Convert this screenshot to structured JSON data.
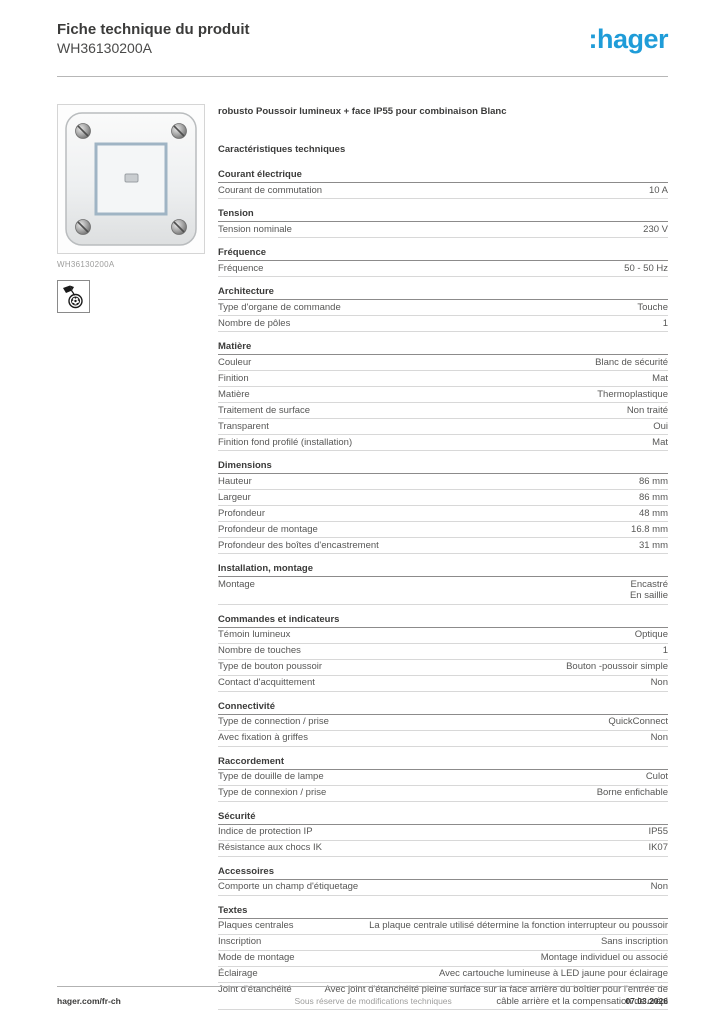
{
  "header": {
    "title": "Fiche technique du produit",
    "product_code": "WH36130200A",
    "brand": ":hager",
    "brand_color": "#1f9cd8"
  },
  "product": {
    "image_caption": "WH36130200A",
    "feature_icon": "paintable-surface-icon"
  },
  "main": {
    "product_title": "robusto Poussoir lumineux + face IP55 pour combinaison Blanc",
    "characteristics_heading": "Caractéristiques techniques",
    "sections": [
      {
        "title": "Courant électrique",
        "rows": [
          {
            "label": "Courant de commutation",
            "value": "10 A"
          }
        ]
      },
      {
        "title": "Tension",
        "rows": [
          {
            "label": "Tension nominale",
            "value": "230 V"
          }
        ]
      },
      {
        "title": "Fréquence",
        "rows": [
          {
            "label": "Fréquence",
            "value": "50 - 50 Hz"
          }
        ]
      },
      {
        "title": "Architecture",
        "rows": [
          {
            "label": "Type d'organe de commande",
            "value": "Touche"
          },
          {
            "label": "Nombre de pôles",
            "value": "1"
          }
        ]
      },
      {
        "title": "Matière",
        "rows": [
          {
            "label": "Couleur",
            "value": "Blanc de sécurité"
          },
          {
            "label": "Finition",
            "value": "Mat"
          },
          {
            "label": "Matière",
            "value": "Thermoplastique"
          },
          {
            "label": "Traitement de surface",
            "value": "Non traité"
          },
          {
            "label": "Transparent",
            "value": "Oui"
          },
          {
            "label": "Finition fond profilé (installation)",
            "value": "Mat"
          }
        ]
      },
      {
        "title": "Dimensions",
        "rows": [
          {
            "label": "Hauteur",
            "value": "86 mm"
          },
          {
            "label": "Largeur",
            "value": "86 mm"
          },
          {
            "label": "Profondeur",
            "value": "48 mm"
          },
          {
            "label": "Profondeur de montage",
            "value": "16.8 mm"
          },
          {
            "label": "Profondeur des boîtes d'encastrement",
            "value": "31 mm"
          }
        ]
      },
      {
        "title": "Installation, montage",
        "rows": [
          {
            "label": "Montage",
            "value": "Encastré\nEn saillie"
          }
        ]
      },
      {
        "title": "Commandes et indicateurs",
        "rows": [
          {
            "label": "Témoin lumineux",
            "value": "Optique"
          },
          {
            "label": "Nombre de touches",
            "value": "1"
          },
          {
            "label": "Type de bouton poussoir",
            "value": "Bouton -poussoir simple"
          },
          {
            "label": "Contact d'acquittement",
            "value": "Non"
          }
        ]
      },
      {
        "title": "Connectivité",
        "rows": [
          {
            "label": "Type de connection / prise",
            "value": "QuickConnect"
          },
          {
            "label": "Avec fixation à griffes",
            "value": "Non"
          }
        ]
      },
      {
        "title": "Raccordement",
        "rows": [
          {
            "label": "Type de douille de lampe",
            "value": "Culot"
          },
          {
            "label": "Type de connexion / prise",
            "value": "Borne enfichable"
          }
        ]
      },
      {
        "title": "Sécurité",
        "rows": [
          {
            "label": "Indice de protection IP",
            "value": "IP55"
          },
          {
            "label": "Résistance aux chocs IK",
            "value": "IK07"
          }
        ]
      },
      {
        "title": "Accessoires",
        "rows": [
          {
            "label": "Comporte un champ d'étiquetage",
            "value": "Non"
          }
        ]
      },
      {
        "title": "Textes",
        "rows": [
          {
            "label": "Plaques centrales",
            "value": "La plaque centrale utilisé détermine la fonction interrupteur ou poussoir"
          },
          {
            "label": "Inscription",
            "value": "Sans inscription"
          },
          {
            "label": "Mode de montage",
            "value": "Montage individuel ou associé"
          },
          {
            "label": "Éclairage",
            "value": "Avec cartouche lumineuse à LED jaune pour éclairage"
          },
          {
            "label": "Joint d'étanchéité",
            "value": "Avec joint d'étanchéité pleine surface sur la face arrière du boîtier pour l'entrée de câble arrière et la compensation de crépi"
          }
        ]
      }
    ]
  },
  "footer": {
    "left": "hager.com/fr-ch",
    "center": "Sous réserve de modifications techniques",
    "right": "07.03.2026"
  }
}
